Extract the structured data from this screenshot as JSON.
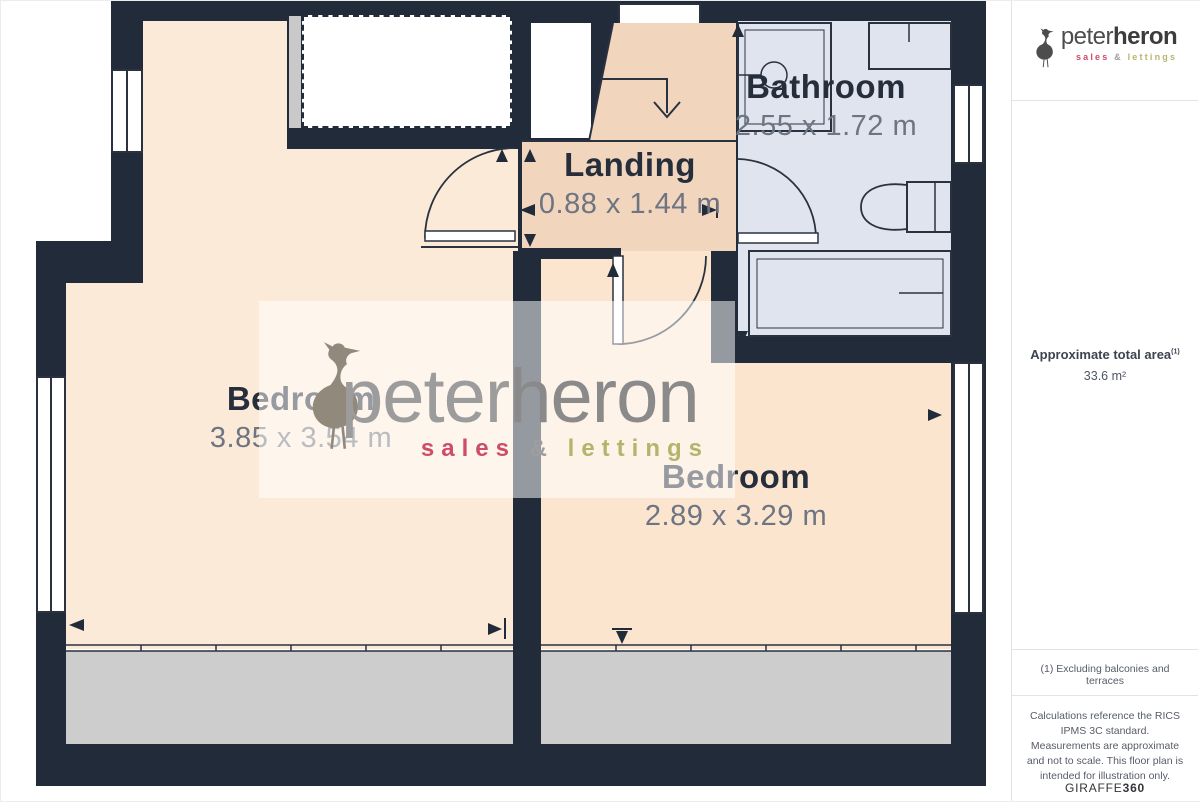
{
  "plan": {
    "rooms": [
      {
        "name": "Bathroom",
        "dimensions": "2.55 x 1.72 m"
      },
      {
        "name": "Landing",
        "dimensions": "0.88 x 1.44 m"
      },
      {
        "name": "Bedroom",
        "dimensions": "3.85 x 3.54 m"
      },
      {
        "name": "Bedroom",
        "dimensions": "2.89 x 3.29 m"
      }
    ],
    "icons": {
      "stairs": "stairs-down-arrow-icon",
      "brand_bird": "heron-icon"
    },
    "colors": {
      "wall": "#222b3a",
      "bedroom_left": "#fcead8",
      "bedroom_right": "#fbe5cf",
      "landing": "#f1d5bd",
      "bathroom": "#e0e4ef",
      "eaves_strip": "#cdcdcd"
    }
  },
  "watermark": {
    "brand_light": "peter",
    "brand_bold": "heron",
    "tag_sales": "sales",
    "tag_amp": "&",
    "tag_lettings": "lettings"
  },
  "sidebar": {
    "logo": {
      "brand_light": "peter",
      "brand_bold": "heron",
      "tag_sales": "sales",
      "tag_amp": "&",
      "tag_lettings": "lettings"
    },
    "area_title": "Approximate total area",
    "area_note_ref": "(1)",
    "area_value": "33.6 m²",
    "footnote": "(1) Excluding balconies and terraces",
    "disclaimer": "Calculations reference the RICS IPMS 3C standard. Measurements are approximate and not to scale. This floor plan is intended for illustration only.",
    "credit": {
      "brand": "GIRAFFE",
      "suffix": "360"
    },
    "colors": {
      "sales": "#c9415b",
      "lettings": "#b3b15e"
    }
  }
}
